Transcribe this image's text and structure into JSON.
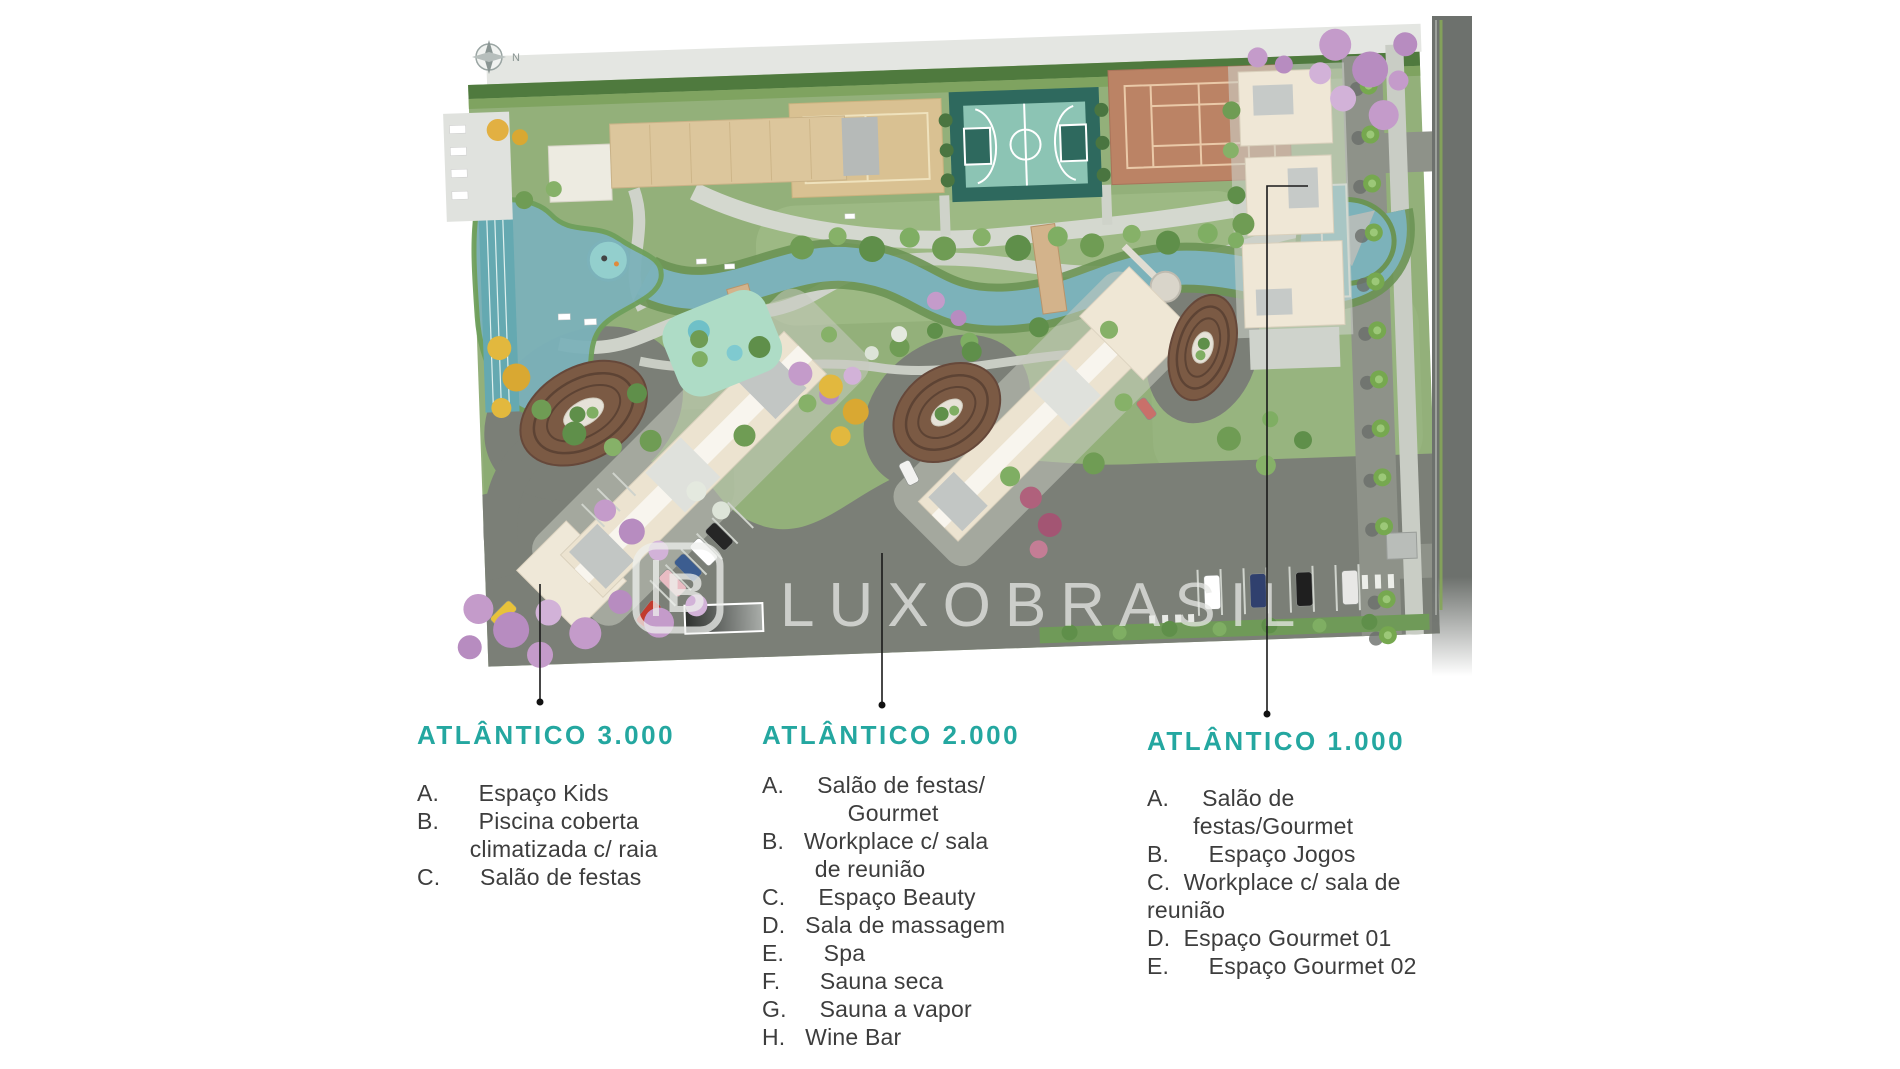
{
  "compass": {
    "label": "N"
  },
  "watermark": {
    "monogram": "B",
    "name": "LUXOBRASIL"
  },
  "legend": {
    "atlantico_3000": {
      "title": "ATLÂNTICO 3.000",
      "body": "A.      Espaço Kids\nB.      Piscina coberta\n        climatizada c/ raia\nC.      Salão de festas"
    },
    "atlantico_2000": {
      "title": "ATLÂNTICO 2.000",
      "body": "A.     Salão de festas/\n             Gourmet\nB.   Workplace c/ sala\n        de reunião\nC.     Espaço Beauty\nD.   Sala de massagem\nE.      Spa\nF.      Sauna seca\nG.     Sauna a vapor\nH.   Wine Bar"
    },
    "atlantico_1000": {
      "title": "ATLÂNTICO 1.000",
      "body": "A.     Salão de\n       festas/Gourmet\nB.      Espaço Jogos\nC.  Workplace c/ sala de\nreunião\nD.  Espaço Gourmet 01\nE.      Espaço Gourmet 02"
    }
  },
  "colors": {
    "title_teal": "#24a7a0",
    "body_text": "#3d3d3d",
    "water": "#7cb2ba",
    "lawn": "#93b07a",
    "road_dark": "#7b7f77",
    "street_band": "#6d716d",
    "path_light": "#cfd3ca",
    "track_brown": "#7b5a44",
    "building_cream": "#ece3d0",
    "court_sand": "#d9c192",
    "court_basketball": "#2e695e",
    "court_tennis": "#bb8365",
    "tree_purple": "#c49bca",
    "tree_yellow": "#e2b83e"
  }
}
